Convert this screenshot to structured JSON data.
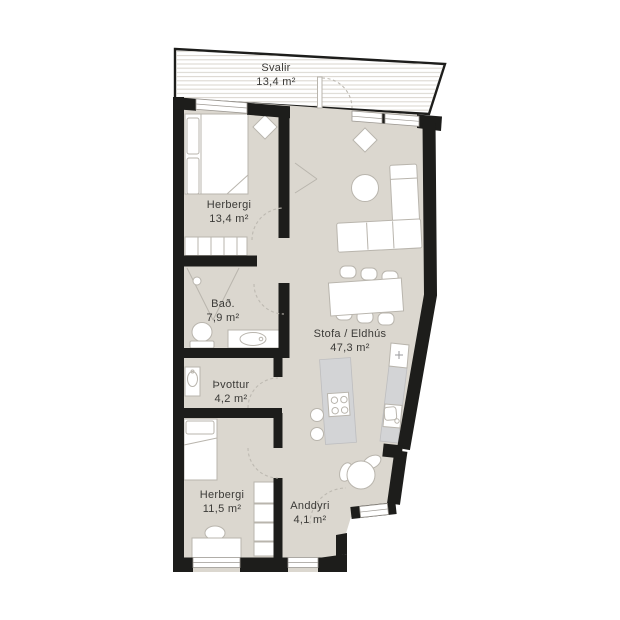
{
  "document": {
    "type": "apartment-floor-plan"
  },
  "colors": {
    "wall": "#1d1d1b",
    "floor": "#dbd7cf",
    "furn": "#b9b5ad",
    "counter": "#d3d4d6",
    "counterline": "#bdbdbf",
    "winline": "#9d9993",
    "arc": "#bdb9b1",
    "deck": "#dcd8d1",
    "text": "#3b3a37"
  },
  "rooms": [
    {
      "id": "svalir",
      "name": "Svalir",
      "area": "13,4 m²"
    },
    {
      "id": "herbergi-1",
      "name": "Herbergi",
      "area": "13,4 m²"
    },
    {
      "id": "bad",
      "name": "Bað.",
      "area": "7,9 m²"
    },
    {
      "id": "thvottur",
      "name": "Þvottur",
      "area": "4,2 m²"
    },
    {
      "id": "herbergi-2",
      "name": "Herbergi",
      "area": "11,5 m²"
    },
    {
      "id": "stofa-eldhus",
      "name": "Stofa / Eldhús",
      "area": "47,3 m²"
    },
    {
      "id": "anddyri",
      "name": "Anddyri",
      "area": "4,1 m²"
    }
  ]
}
